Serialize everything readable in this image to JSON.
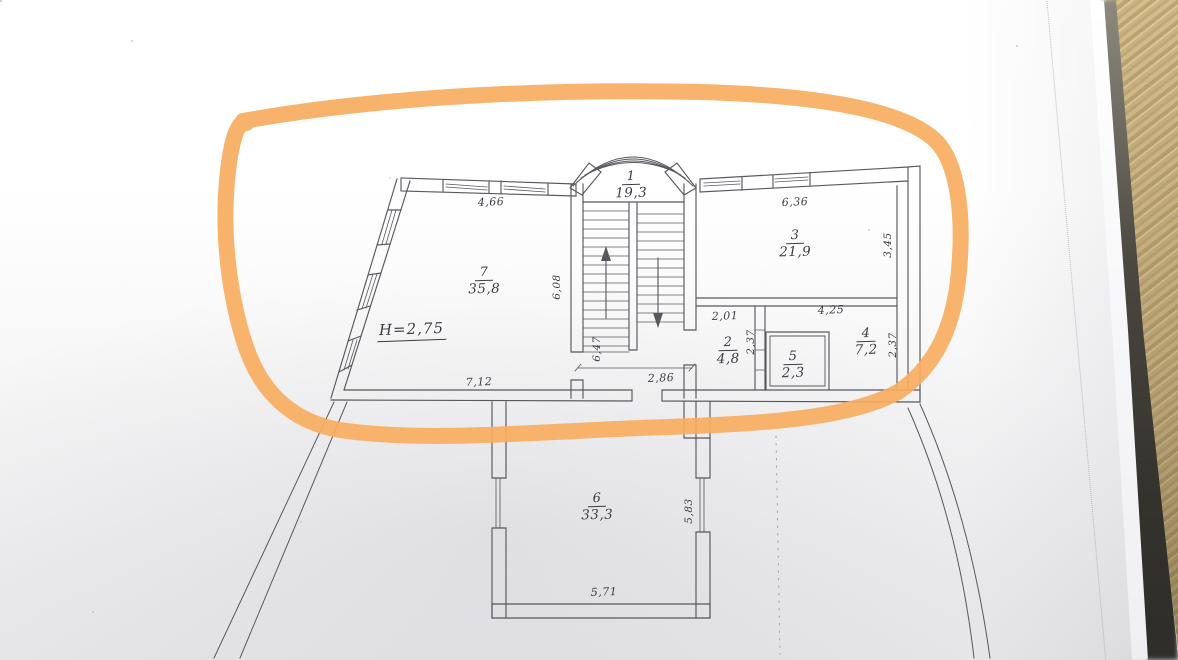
{
  "floor_plan": {
    "rooms": {
      "r1": {
        "number": "1",
        "area": "19,3"
      },
      "r2": {
        "number": "2",
        "area": "4,8"
      },
      "r3": {
        "number": "3",
        "area": "21,9"
      },
      "r4": {
        "number": "4",
        "area": "7,2"
      },
      "r5": {
        "number": "5",
        "area": "2,3"
      },
      "r6": {
        "number": "6",
        "area": "33,3"
      },
      "r7": {
        "number": "7",
        "area": "35,8"
      }
    },
    "height_note": "H=2,75",
    "dimensions": {
      "room7_top_width": "4,66",
      "room7_bottom_width": "7,12",
      "room7_right_height": "6,08",
      "room3_top_width": "6,36",
      "room3_right_height": "3,45",
      "room2_top_width": "2,01",
      "room2_right_height": "2,37",
      "room4_top_width": "4,25",
      "room4_right_height": "2,37",
      "landing_left_height": "6,47",
      "landing_bottom_width": "2,86",
      "room6_right_height": "5,83",
      "room6_bottom_width": "5,71"
    },
    "highlight_color": "#f7ad5f"
  }
}
